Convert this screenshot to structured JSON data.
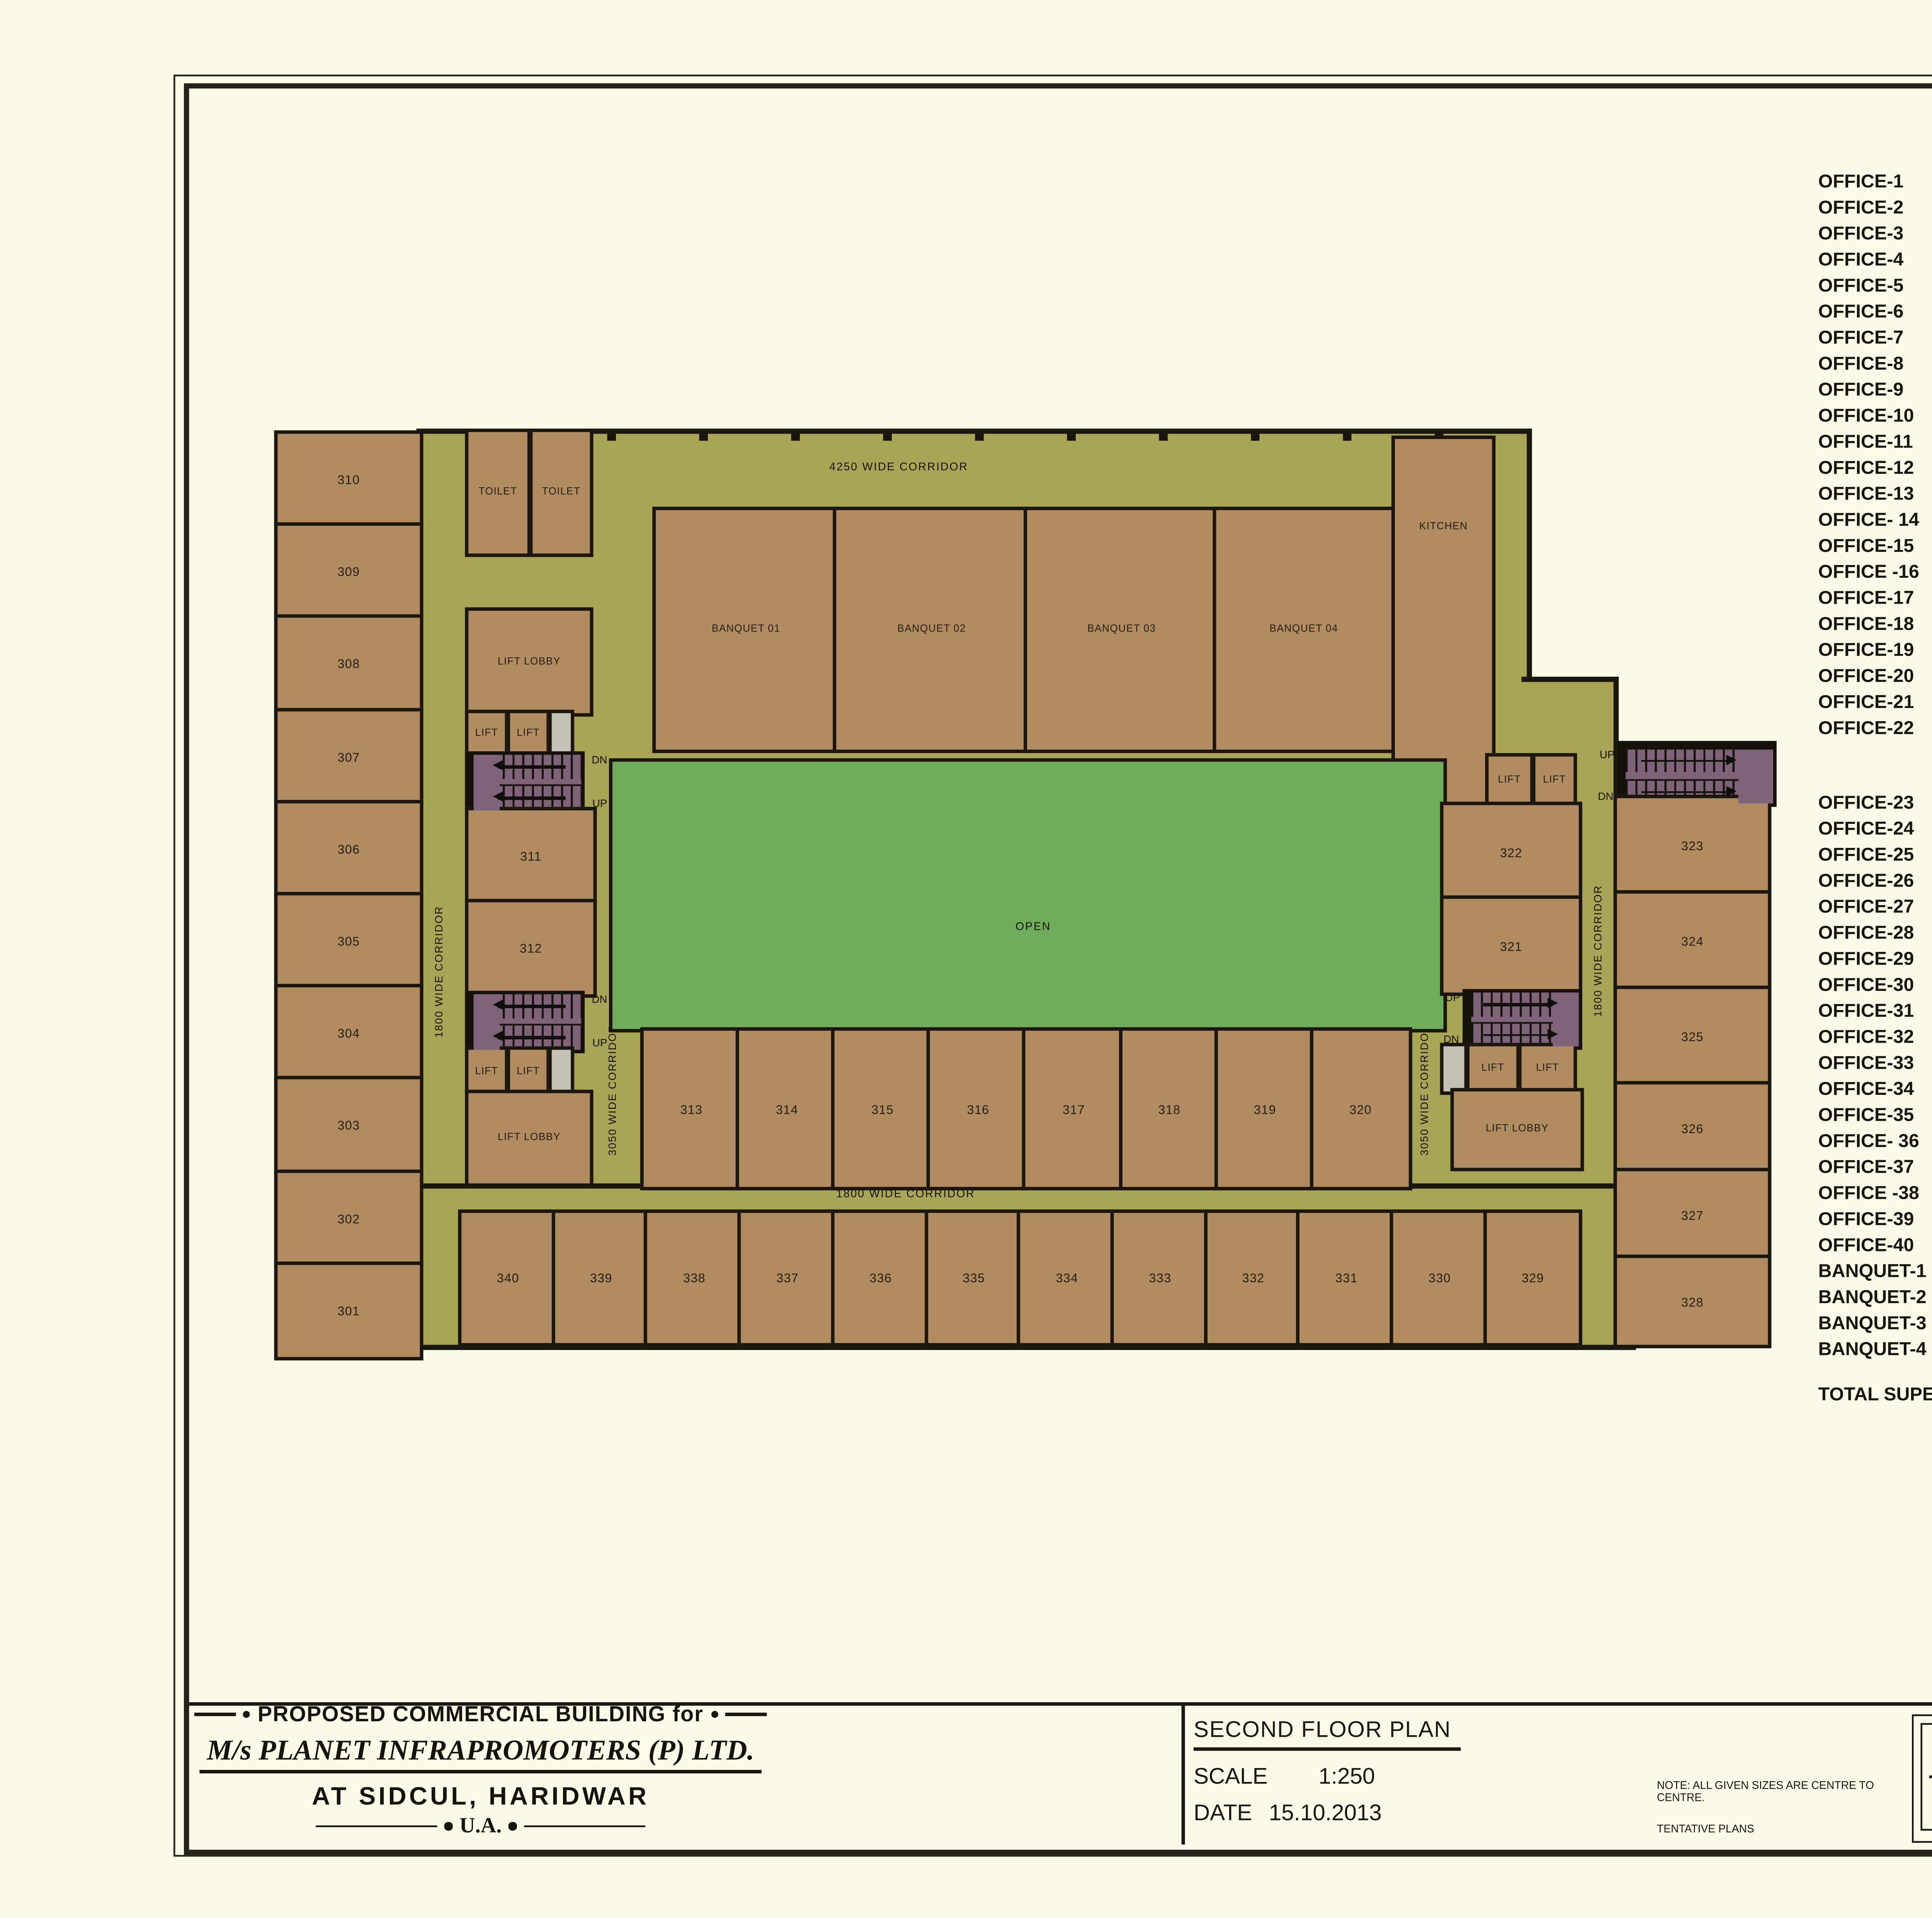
{
  "colors": {
    "paper": "#FBFAE9",
    "corridor_olive": "#A9A557",
    "room_tan": "#B18C60",
    "open_green": "#6FAD5B",
    "stair_purple": "#7F6379",
    "wall": "#1B160E"
  },
  "tables": {
    "headers": [
      "SIZE",
      "SIZE",
      "SUPER AREA"
    ],
    "table1_rows": [
      [
        "OFFICE-1",
        "7.85",
        "5.035",
        "61.757",
        "664.750"
      ],
      [
        "OFFICE-2",
        "7.85",
        "4.92",
        "60.347",
        "649.567"
      ],
      [
        "OFFICE-3",
        "7.85",
        "4.92",
        "60.347",
        "649.567"
      ],
      [
        "OFFICE-4",
        "7.85",
        "4.92",
        "60.347",
        "649.567"
      ],
      [
        "OFFICE-5",
        "7.85",
        "4.92",
        "60.347",
        "649.567"
      ],
      [
        "OFFICE-6",
        "7.85",
        "4.92",
        "60.347",
        "649.567"
      ],
      [
        "OFFICE-7",
        "7.85",
        "4.92",
        "60.347",
        "649.567"
      ],
      [
        "OFFICE-8",
        "7.85",
        "4.92",
        "60.347",
        "649.567"
      ],
      [
        "OFFICE-9",
        "7.85",
        "4.92",
        "60.347",
        "649.567"
      ],
      [
        "OFFICE-10",
        "7.85",
        "5.035",
        "61.757",
        "664.750"
      ],
      [
        "OFFICE-11",
        "7.85",
        "4.92",
        "60.347",
        "649.567"
      ],
      [
        "OFFICE-12",
        "7.85",
        "4.92",
        "60.347",
        "649.567"
      ],
      [
        "OFFICE-13",
        "5.035",
        "7.85",
        "61.757",
        "664.750"
      ],
      [
        "OFFICE- 14",
        "4.92",
        "7.85",
        "60.347",
        "649.567"
      ],
      [
        "OFFICE-15",
        "4.92",
        "7.85",
        "60.347",
        "649.567"
      ],
      [
        "OFFICE -16",
        "4.92",
        "7.85",
        "60.347",
        "649.567"
      ],
      [
        "OFFICE-17",
        "4.92",
        "7.85",
        "60.347",
        "649.567"
      ],
      [
        "OFFICE-18",
        "4.92",
        "7.85",
        "60.347",
        "649.567"
      ],
      [
        "OFFICE-19",
        "4.92",
        "7.85",
        "60.347",
        "649.567"
      ],
      [
        "OFFICE-20",
        "5.035",
        "7.85",
        "61.757",
        "664.750"
      ],
      [
        "OFFICE-21",
        "7.85",
        "4.92",
        "60.347",
        "649.567"
      ],
      [
        "OFFICE-22",
        "7.85",
        "4.92",
        "60.347",
        "649.567"
      ]
    ],
    "table2_rows": [
      [
        "OFFICE-23",
        "7.85",
        "4.92",
        "60.347",
        "649.567"
      ],
      [
        "OFFICE-24",
        "7.85",
        "4.92",
        "60.347",
        "649.567"
      ],
      [
        "OFFICE-25",
        "7.85",
        "4.92",
        "60.347",
        "649.567"
      ],
      [
        "OFFICE-26",
        "7.85",
        "4.92",
        "60.347",
        "649.567"
      ],
      [
        "OFFICE-27",
        "7.85",
        "4.92",
        "60.347",
        "649.567"
      ],
      [
        "OFFICE-28",
        "7.85",
        "5.035",
        "61.757",
        "664.750"
      ],
      [
        "OFFICE-29",
        "4.895",
        "7.85",
        "60.040",
        "646.266"
      ],
      [
        "OFFICE-30",
        "4.92",
        "7.85",
        "60.347",
        "649.567"
      ],
      [
        "OFFICE-31",
        "4.92",
        "7.85",
        "60.347",
        "649.567"
      ],
      [
        "OFFICE-32",
        "4.92",
        "7.85",
        "60.347",
        "649.567"
      ],
      [
        "OFFICE-33",
        "4.92",
        "7.85",
        "60.347",
        "649.567"
      ],
      [
        "OFFICE-34",
        "4.92",
        "7.85",
        "60.347",
        "649.567"
      ],
      [
        "OFFICE-35",
        "4.92",
        "7.85",
        "60.347",
        "649.567"
      ],
      [
        "OFFICE- 36",
        "4.92",
        "7.85",
        "60.347",
        "649.567"
      ],
      [
        "OFFICE-37",
        "4.92",
        "7.85",
        "60.347",
        "649.567"
      ],
      [
        "OFFICE -38",
        "4.92",
        "7.85",
        "60.347",
        "649.567"
      ],
      [
        "OFFICE-39",
        "4.92",
        "7.85",
        "60.347",
        "649.567"
      ],
      [
        "OFFICE-40",
        "4.895",
        "7.85",
        "60.040",
        "646.266"
      ],
      [
        "BANQUET-1",
        "9.955",
        "13.135",
        "204.311",
        "2199.179"
      ],
      [
        "BANQUET-2",
        "9.84",
        "13.135",
        "201.951",
        "2173.774"
      ],
      [
        "BANQUET-3",
        "9.84",
        "13.135",
        "201.951",
        "2173.774"
      ],
      [
        "BANQUET-4",
        "9.84",
        "13.135",
        "201.951",
        "2173.774"
      ]
    ],
    "total": {
      "label": "TOTAL SUPER AREA",
      "v1": "3230.477",
      "v2": "34772.501"
    }
  },
  "plan": {
    "open_label": "OPEN",
    "kitchen_label": "KITCHEN",
    "toilet_label": "TOILET",
    "lift_label": "LIFT",
    "lift_lobby_label": "LIFT LOBBY",
    "up_label": "UP",
    "dn_label": "DN",
    "corridor_top": "4250 WIDE CORRIDOR",
    "corridor_bottom": "1800 WIDE CORRIDOR",
    "corridor_left": "1800 WIDE CORRIDOR",
    "corridor_right": "1800 WIDE CORRIDOR",
    "corridor_mid_left": "3050 WIDE CORRIDOR",
    "corridor_mid_right": "3050 WIDE CORRIDOR",
    "banquets": [
      "BANQUET 01",
      "BANQUET 02",
      "BANQUET 03",
      "BANQUET 04"
    ],
    "left_rooms": [
      "310",
      "309",
      "308",
      "307",
      "306",
      "305",
      "304",
      "303",
      "302",
      "301"
    ],
    "inner_left_rooms": [
      "311",
      "312"
    ],
    "mid_rooms": [
      "313",
      "314",
      "315",
      "316",
      "317",
      "318",
      "319",
      "320"
    ],
    "bottom_rooms": [
      "340",
      "339",
      "338",
      "337",
      "336",
      "335",
      "334",
      "333",
      "332",
      "331",
      "330",
      "329"
    ],
    "right_inner_rooms": [
      "322",
      "321"
    ],
    "right_rooms": [
      "323",
      "324",
      "325",
      "326",
      "327",
      "328"
    ]
  },
  "title_block": {
    "left": {
      "line1": "PROPOSED COMMERCIAL BUILDING for",
      "company": "M/s PLANET INFRAPROMOTERS (P) LTD.",
      "city": "AT SIDCUL, HARIDWAR",
      "ua": "U.A."
    },
    "center": {
      "plan_title": "SECOND FLOOR PLAN",
      "scale_label": "SCALE",
      "scale_value": "1:250",
      "date_label": "DATE",
      "date_value": "15.10.2013"
    },
    "notes": {
      "note1": "NOTE: ALL GIVEN SIZES ARE CENTRE TO CENTRE.",
      "note2": "TENTATIVE PLANS"
    },
    "right": {
      "heading": "ARCHITECTS",
      "firm": "ANDLEYS  ASSOCIATES  (P)  LTD.",
      "subtitle": "ARCHITECTS,  ENGINEERS  PLANNERS",
      "address": "39,  HOUSING  SOCIETY,  SOUTH-EX  -1  NEW  DELHI-110049.",
      "sheet_no": "A-01"
    }
  }
}
